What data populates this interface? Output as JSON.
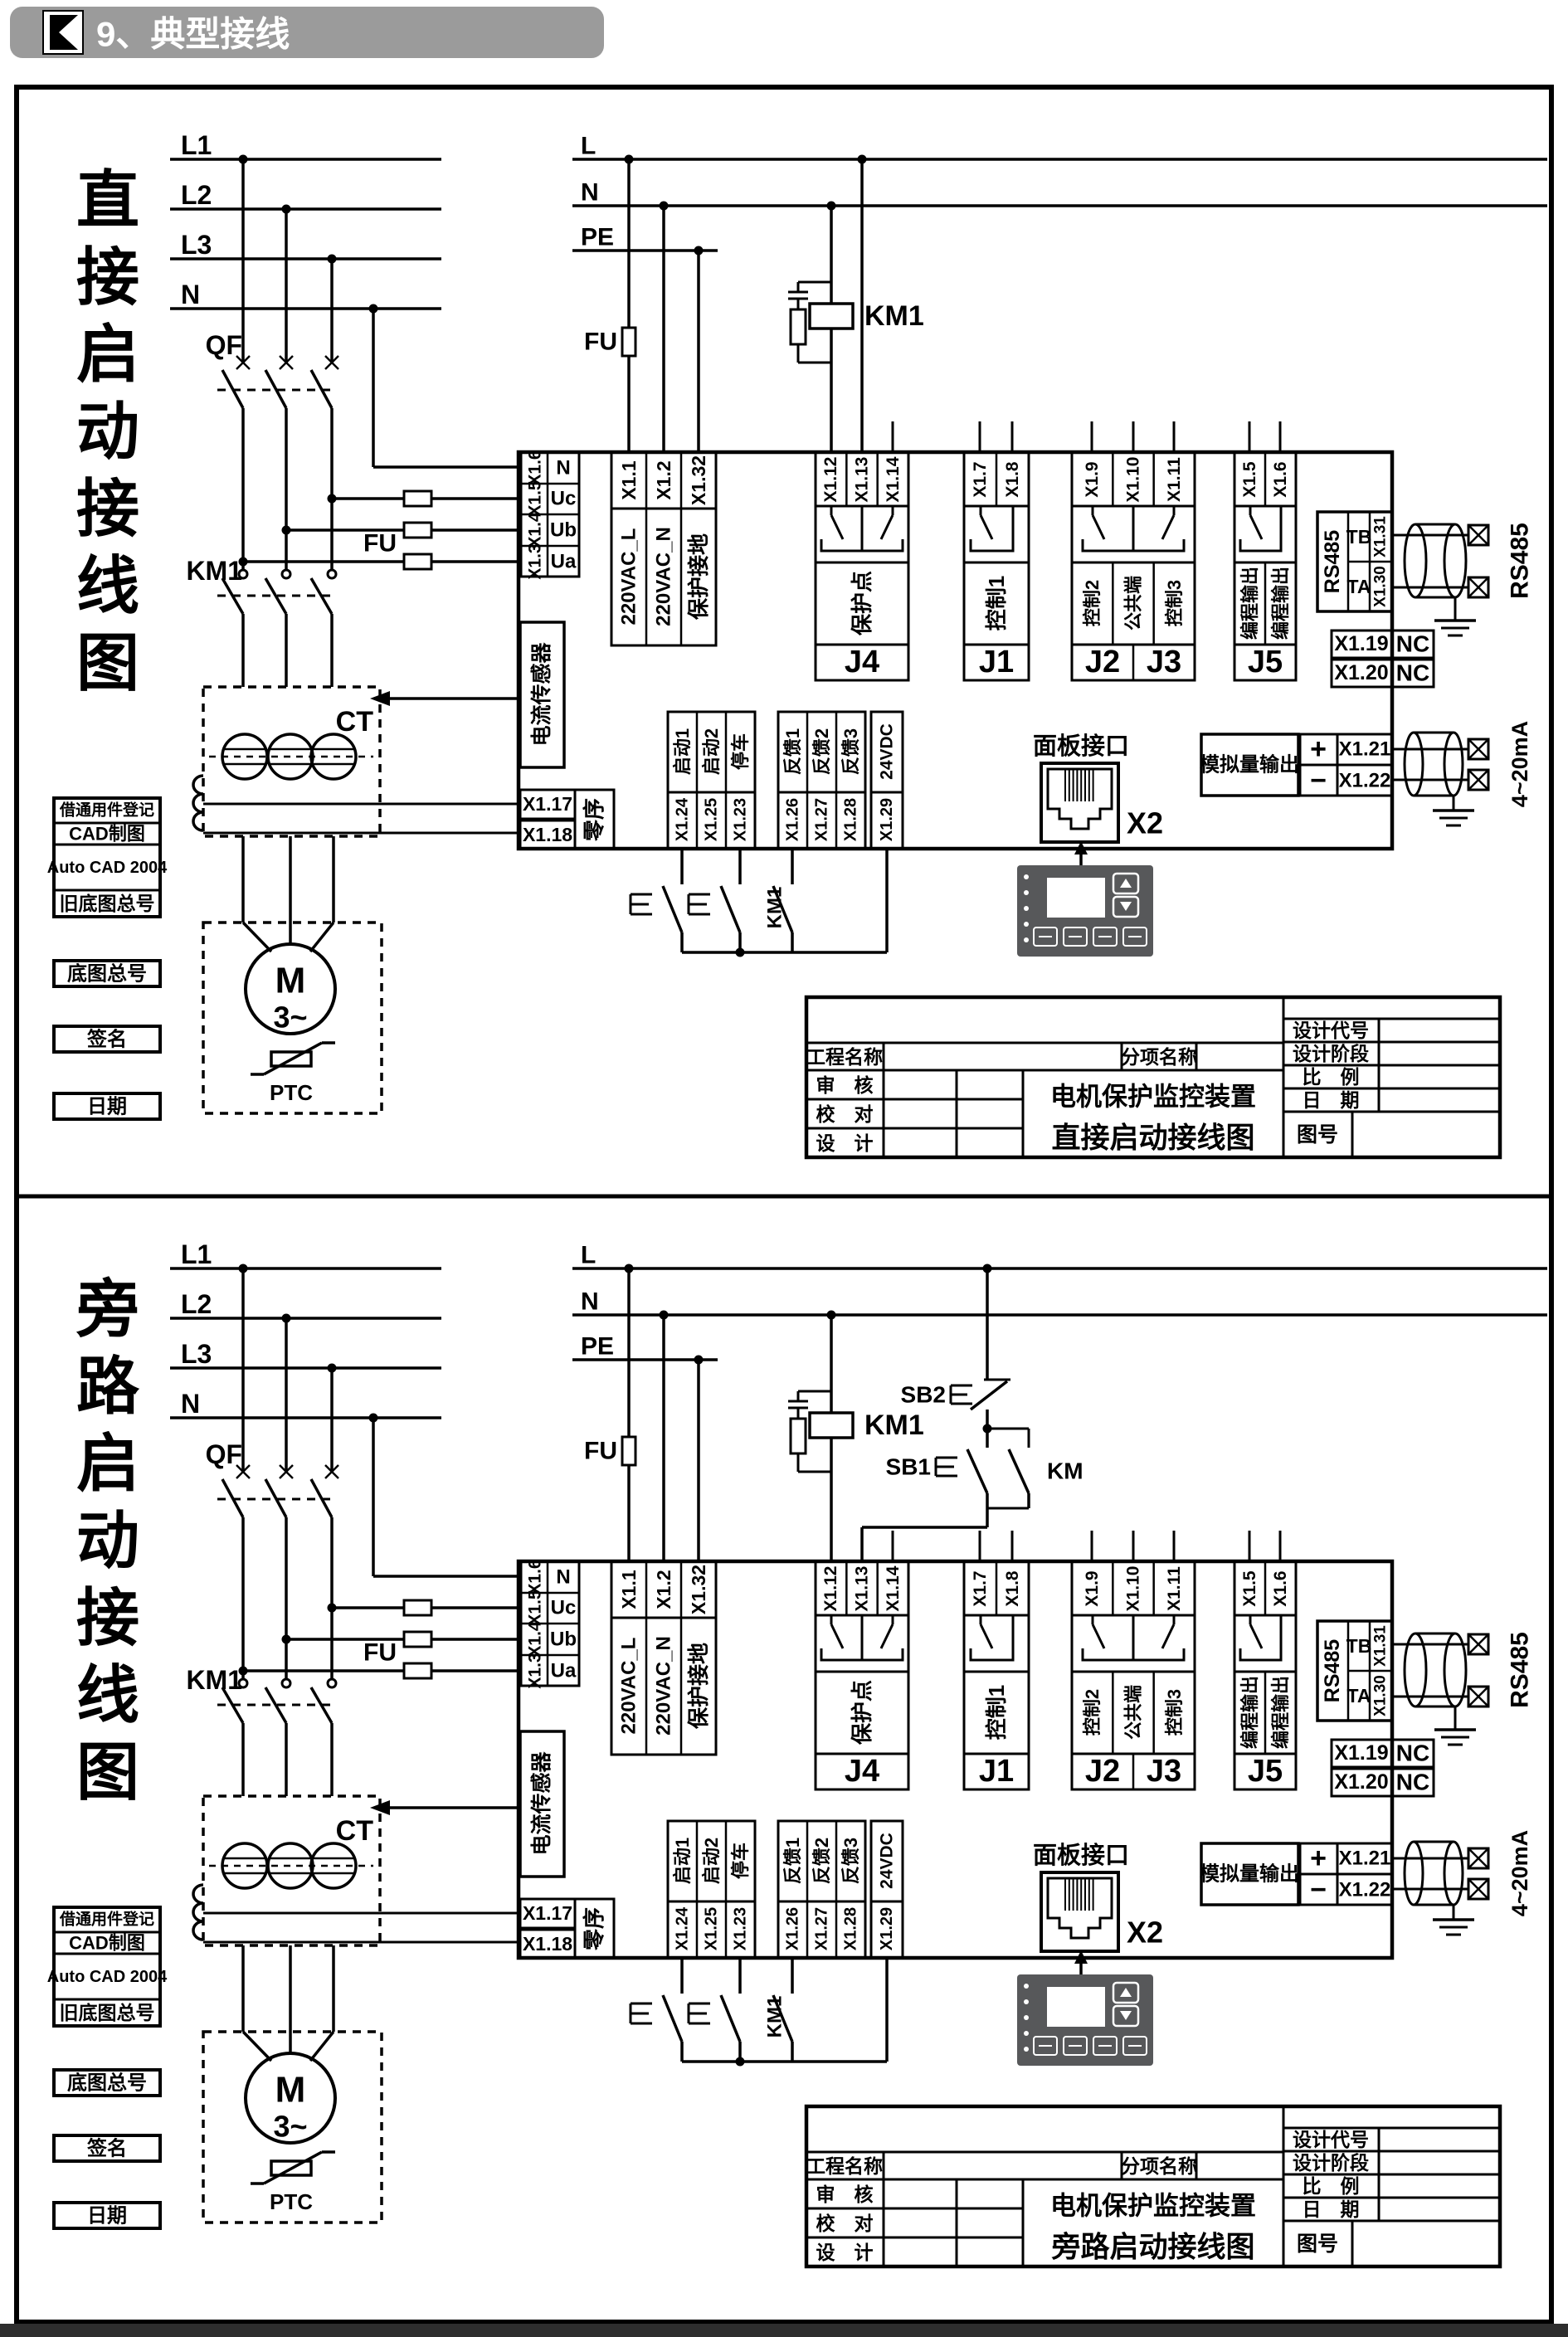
{
  "header": {
    "title": "9、典型接线"
  },
  "colors": {
    "header_bar": "#9b9b9b",
    "keypad": "#57585a",
    "ink": "#000000",
    "paper": "#ffffff",
    "footer": "#2e2e2e"
  },
  "panels": [
    {
      "side_title": "直接启动接线图",
      "drawing_title": "直接启动接线图",
      "bypass": false
    },
    {
      "side_title": "旁路启动接线图",
      "drawing_title": "旁路启动接线图",
      "bypass": true
    }
  ],
  "schematic": {
    "phases": [
      "L1",
      "L2",
      "L3",
      "N"
    ],
    "control_lines": [
      "L",
      "N",
      "PE"
    ],
    "breaker": "QF",
    "contactor": "KM1",
    "coil": "KM1",
    "fuse": "FU",
    "ct": "CT",
    "motor": "M",
    "motor_phases": "3~",
    "ptc": "PTC",
    "voltage_rows": [
      [
        "X1.6",
        "N"
      ],
      [
        "X1.5",
        "Uc"
      ],
      [
        "X1.4",
        "Ub"
      ],
      [
        "X1.3",
        "Ua"
      ]
    ],
    "sensor": "电流传感器",
    "zero_terms": [
      "X1.17",
      "X1.18"
    ],
    "zero_label": "零序",
    "mains_cols": [
      [
        "X1.1",
        "220VAC_L"
      ],
      [
        "X1.2",
        "220VAC_N"
      ],
      [
        "X1.32",
        "保护接地"
      ]
    ],
    "j4": {
      "terms": [
        "X1.12",
        "X1.13",
        "X1.14"
      ],
      "label": "保护点",
      "name": "J4"
    },
    "j1": {
      "terms": [
        "X1.7",
        "X1.8"
      ],
      "label": "控制1",
      "name": "J1"
    },
    "j23": {
      "terms": [
        "X1.9",
        "X1.10",
        "X1.11"
      ],
      "labels": [
        "控制2",
        "公共端",
        "控制3"
      ],
      "names": [
        "J2",
        "J3"
      ]
    },
    "j5": {
      "terms": [
        "X1.5",
        "X1.6"
      ],
      "labels": [
        "编程输出",
        "编程输出"
      ],
      "name": "J5"
    },
    "rs485": {
      "side": "RS485",
      "rows": [
        [
          "TB",
          "X1.31"
        ],
        [
          "TA",
          "X1.30"
        ]
      ],
      "ext": "RS485"
    },
    "nc": [
      [
        "X1.19",
        "NC"
      ],
      [
        "X1.20",
        "NC"
      ]
    ],
    "analog": {
      "label": "模拟量输出",
      "rows": [
        [
          "+",
          "X1.21"
        ],
        [
          "−",
          "X1.22"
        ]
      ],
      "ext": "4~20mA"
    },
    "panel_port": {
      "label": "面板接口",
      "conn": "X2"
    },
    "din": {
      "start": [
        [
          "启动1",
          "X1.24"
        ],
        [
          "启动2",
          "X1.25"
        ],
        [
          "停车",
          "X1.23"
        ]
      ],
      "feedback": [
        [
          "反馈1",
          "X1.26"
        ],
        [
          "反馈2",
          "X1.27"
        ],
        [
          "反馈3",
          "X1.28"
        ]
      ],
      "supply": [
        "24VDC",
        "X1.29"
      ],
      "km_aux": "KM1"
    },
    "bypass": {
      "sb2": "SB2",
      "sb1": "SB1",
      "km": "KM"
    },
    "left_stack": [
      "借通用件登记",
      "CAD制图",
      "Auto CAD 2004",
      "旧底图总号"
    ],
    "left_singles": [
      "底图总号",
      "签名",
      "日期"
    ],
    "title_block": {
      "project": "工程名称",
      "item": "分项名称",
      "review": "审　核",
      "proof": "校　对",
      "design": "设　计",
      "code": "设计代号",
      "stage": "设计阶段",
      "scale": "比　例",
      "date": "日　期",
      "number": "图号",
      "device": "电机保护监控装置"
    }
  }
}
